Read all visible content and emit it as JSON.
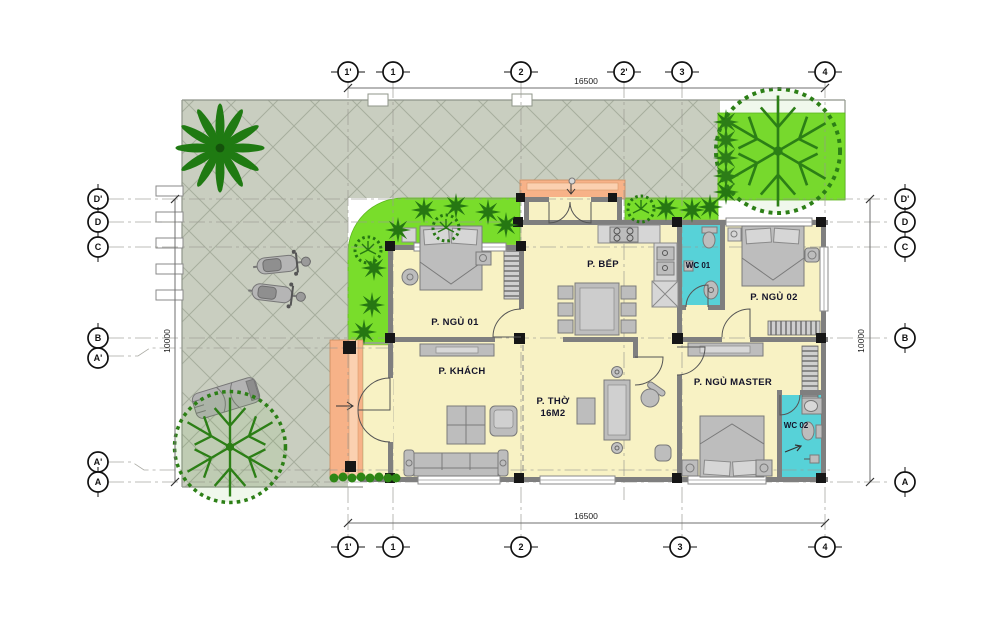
{
  "plan": {
    "rooms": {
      "bedroom1": "P. NGỦ 01",
      "living": "P. KHÁCH",
      "worship_line1": "P. THỜ",
      "worship_line2": "16M2",
      "kitchen": "P. BẾP",
      "wc1": "WC 01",
      "bedroom2": "P. NGỦ 02",
      "master": "P. NGỦ MASTER",
      "wc2": "WC 02"
    },
    "dimensions": {
      "horizontal": "16500",
      "vertical": "10000"
    },
    "grid": {
      "top": [
        "1'",
        "1",
        "2",
        "2'",
        "3",
        "4"
      ],
      "bottom": [
        "1'",
        "1",
        "2",
        "3",
        "4"
      ],
      "left": [
        "D'",
        "D",
        "C",
        "B",
        "A'",
        "A'",
        "A"
      ],
      "right": [
        "D'",
        "D",
        "C",
        "B",
        "A"
      ]
    },
    "colors": {
      "yard": "#c9cec0",
      "floor": "#f8f2c4",
      "wc": "#57d2d8",
      "garden": "#79dd2b",
      "tree": "#267712",
      "porch": "#f7b288",
      "wall": "#7f7f7f"
    }
  }
}
